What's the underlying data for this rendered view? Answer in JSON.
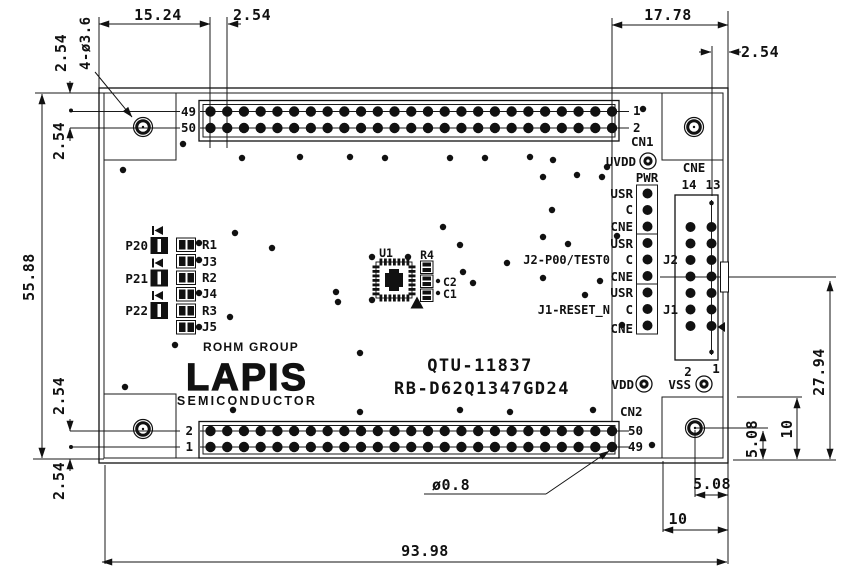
{
  "dims": {
    "d15_24": "15.24",
    "d2_54": "2.54",
    "d17_78": "17.78",
    "d55_88": "55.88",
    "d93_98": "93.98",
    "d27_94": "27.94",
    "d10": "10",
    "d5_08": "5.08",
    "hole_callout": "4-ø3.6",
    "pin_callout": "ø0.8"
  },
  "connectors": {
    "cn1": {
      "name": "CN1",
      "pin_tl": "49",
      "pin_bl": "50",
      "pin_tr": "1",
      "pin_br": "2"
    },
    "cn2": {
      "name": "CN2",
      "pin_tl": "2",
      "pin_bl": "1",
      "pin_tr": "50",
      "pin_br": "49"
    },
    "cne": {
      "name": "CNE",
      "col_a": "14",
      "col_b": "13"
    }
  },
  "headers": {
    "pwr": {
      "label": "PWR",
      "pins": [
        "USR",
        "C",
        "CNE"
      ]
    },
    "j2": {
      "label": "J2",
      "pins": [
        "USR",
        "C",
        "CNE"
      ],
      "callout": "J2-P00/TEST0"
    },
    "j1": {
      "label": "J1",
      "pins": [
        "USR",
        "C",
        "CNE"
      ],
      "callout": "J1-RESET_N"
    }
  },
  "pads": {
    "uvdd": "UVDD",
    "vdd": "VDD",
    "vss": "VSS",
    "vss_pin2": "2",
    "vss_pin1": "1"
  },
  "components": {
    "u1": "U1",
    "r4": "R4",
    "c2": "C2",
    "c1": "C1",
    "led_labels": [
      "P20",
      "P21",
      "P22"
    ],
    "jumper_labels": [
      "R1",
      "J3",
      "R2",
      "J4",
      "R3",
      "J5"
    ]
  },
  "silkscreen": {
    "group": "ROHM GROUP",
    "brand": "LAPIS",
    "brand_sub": "SEMICONDUCTOR",
    "board_no": "QTU-11837",
    "part_no": "RB-D62Q1347GD24"
  }
}
